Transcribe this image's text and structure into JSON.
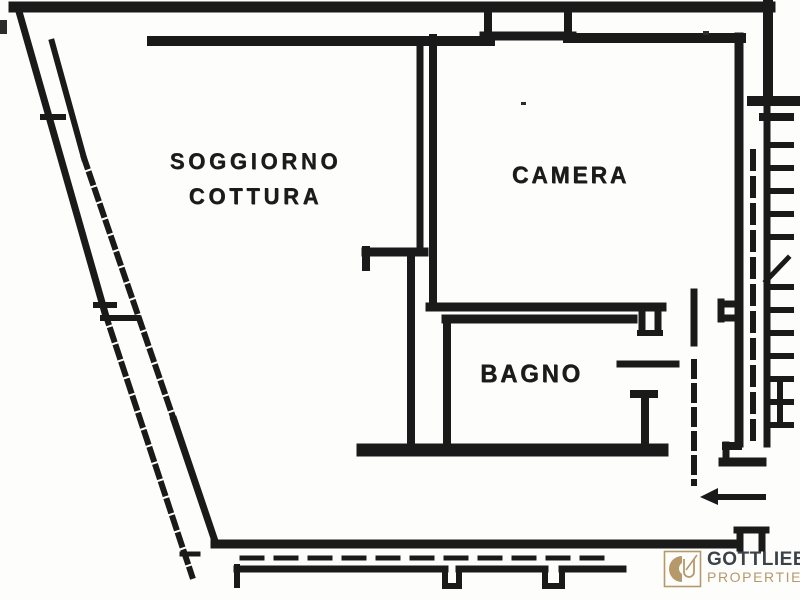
{
  "rooms": {
    "living": {
      "line1": "SOGGIORNO",
      "line2": "COTTURA"
    },
    "bedroom": {
      "label": "CAMERA"
    },
    "bathroom": {
      "label": "BAGNO"
    }
  },
  "logo": {
    "name": "GOTTLIEB",
    "word": "PROPERTIES"
  },
  "colors": {
    "ink": "#1a1a1a",
    "paper": "#fdfdfc",
    "brand_gold": "#b5996b",
    "brand_dark": "#3b4248"
  }
}
